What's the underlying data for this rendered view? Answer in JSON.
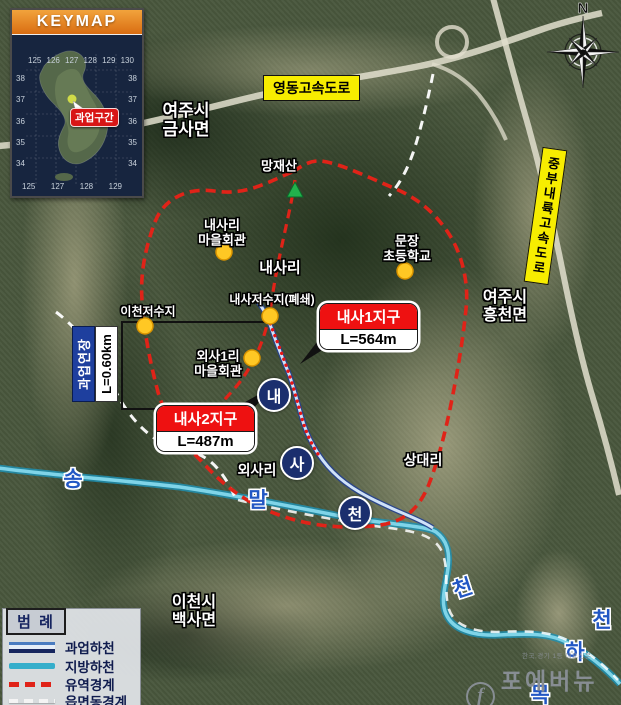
{
  "keymap": {
    "title": "KEYMAP",
    "marker": "과업구간",
    "lon_top": [
      "125",
      "126",
      "127",
      "128",
      "129",
      "130"
    ],
    "lat_left": [
      "38",
      "37",
      "36",
      "35",
      "34"
    ],
    "lat_right": [
      "38",
      "37",
      "36",
      "35",
      "34"
    ],
    "lon_bottom": [
      "125",
      "127",
      "128",
      "129"
    ]
  },
  "compass": {
    "n": "N"
  },
  "highways": {
    "yeongdong": "영동고속도로",
    "jungbu": "중부내륙고속도로"
  },
  "places": {
    "yeoju_geumsa": {
      "l1": "여주시",
      "l2": "금사면"
    },
    "mangjaesan": {
      "l1": "망재산"
    },
    "naesari_hall": {
      "l1": "내사리",
      "l2": "마을회관"
    },
    "naesari": {
      "l1": "내사리"
    },
    "munjang_school": {
      "l1": "문장",
      "l2": "초등학교"
    },
    "yeoju_heungcheon": {
      "l1": "여주시",
      "l2": "흥천면"
    },
    "naesa_reservoir": {
      "l1": "내사저수지(폐쇄)"
    },
    "icheon_reservoir": {
      "l1": "이천저수지"
    },
    "oesa1ri_hall": {
      "l1": "외사1리",
      "l2": "마을회관"
    },
    "oesari": {
      "l1": "외사리"
    },
    "sangdaeri": {
      "l1": "상대리"
    },
    "icheon_baeksa": {
      "l1": "이천시",
      "l2": "백사면"
    }
  },
  "districts": {
    "d1": {
      "name": "내사1지구",
      "length": "L=564m"
    },
    "d2": {
      "name": "내사2지구",
      "length": "L=487m"
    }
  },
  "extent": {
    "label": "과업연장",
    "length": "L=0.60km"
  },
  "rivers": {
    "song": "송",
    "mal": "말",
    "nae": "내",
    "sa": "사",
    "cheon": "천",
    "cheon_w": "천",
    "cheon_e": "천",
    "ha": "하",
    "mok": "목"
  },
  "legend": {
    "title": "범 례",
    "items": [
      {
        "label": "과업하천"
      },
      {
        "label": "지방하천"
      },
      {
        "label": "유역경계"
      },
      {
        "label": "읍면동경계"
      }
    ]
  },
  "watermark": {
    "tagline": "한국,경기 1등 대표신문",
    "logo": "f",
    "name": "포에버뉴스"
  },
  "colors": {
    "highway_label": "#f7ed00",
    "district_red": "#ee1111",
    "watershed_boundary": "#e02318",
    "township_boundary": "#ffffff",
    "project_river_casing": "#24408f",
    "project_river_core": "#cfe2f8",
    "local_river": "#35aecb",
    "extent_blue": "#1e3f9e",
    "marker_yellow": "#ffc824",
    "keymap_header_orange": "#e8821e",
    "river_circle_navy": "#1b2f6e"
  }
}
